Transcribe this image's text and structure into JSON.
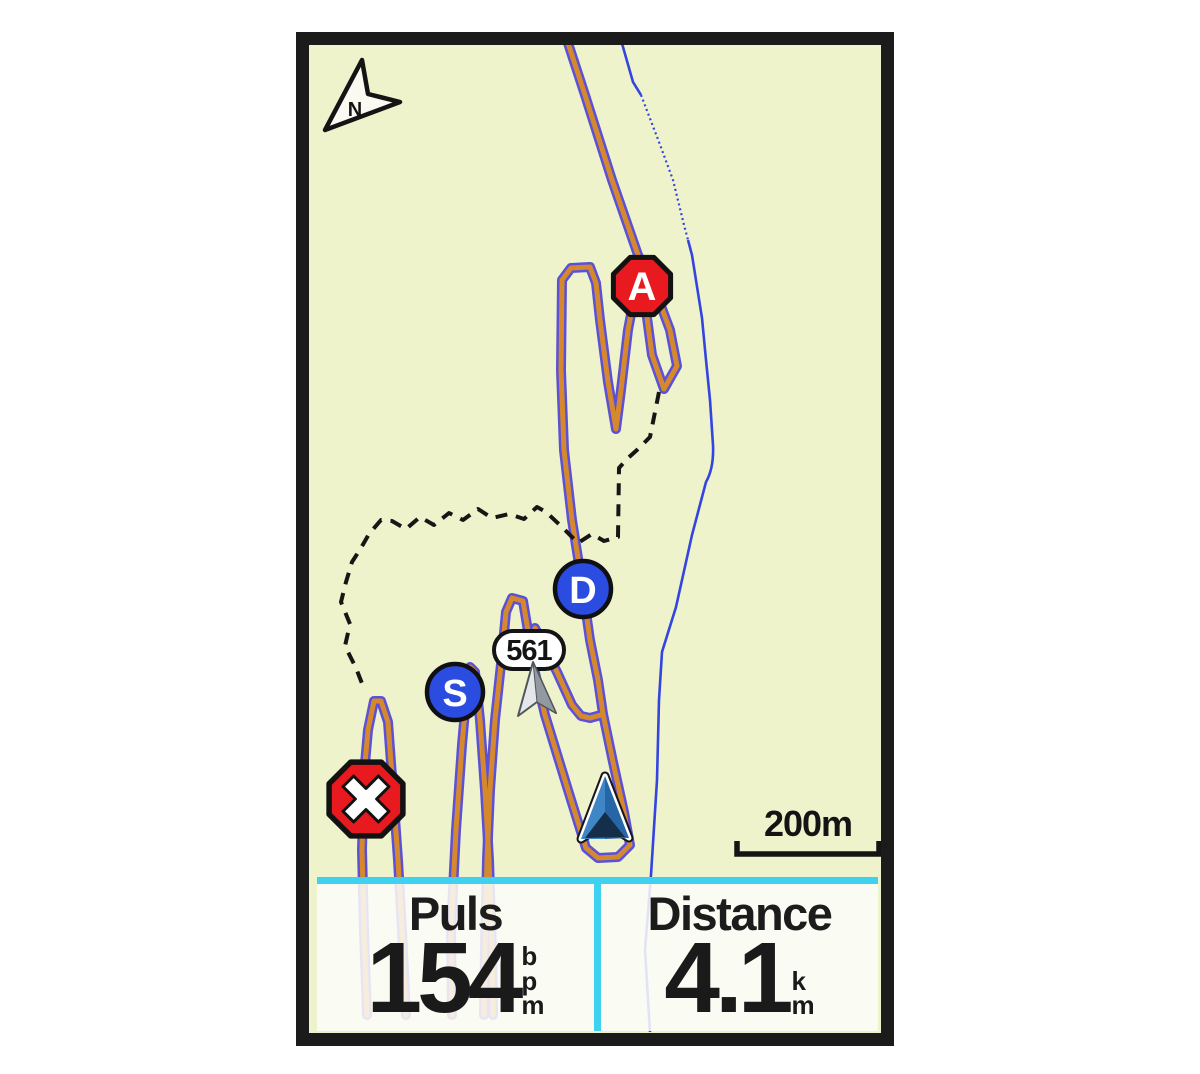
{
  "map": {
    "north_indicator": "N",
    "scale_bar_label": "200m",
    "markers": {
      "point_a_label": "A",
      "point_d_label": "D",
      "point_s_label": "S",
      "waypoint_label": "561"
    },
    "colors": {
      "map_background": "#eef3cb",
      "course_orange": "#d6892c",
      "course_outline_purple": "#5b50d8",
      "water_blue": "#3344e0",
      "trail_dashed_black": "#161616",
      "accent_cyan": "#3ed2f0",
      "marker_blue": "#2b4ce0",
      "marker_red": "#e81a20"
    }
  },
  "data_fields": [
    {
      "label": "Puls",
      "value": "154",
      "unit": "bpm",
      "unit_letters": [
        "b",
        "p",
        "m"
      ]
    },
    {
      "label": "Distance",
      "value": "4.1",
      "unit": "km",
      "unit_letters": [
        "k",
        "m"
      ]
    }
  ]
}
